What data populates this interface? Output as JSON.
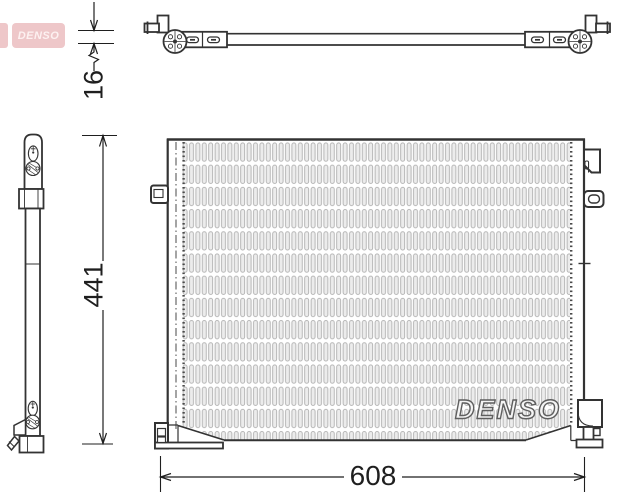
{
  "logo": {
    "text": "DENSO"
  },
  "watermark": {
    "text": "DENSO"
  },
  "dimensions": {
    "thickness": "16",
    "height": "441",
    "width": "608"
  },
  "colors": {
    "line": "#333333",
    "dim": "#1f1f1f",
    "logo-bg": "#eec7c9",
    "logo-text": "#fdf1f1",
    "fin-fill": "#ececec",
    "fin-stroke": "#b0b0b0",
    "wm-stroke": "#5f5f5f"
  }
}
